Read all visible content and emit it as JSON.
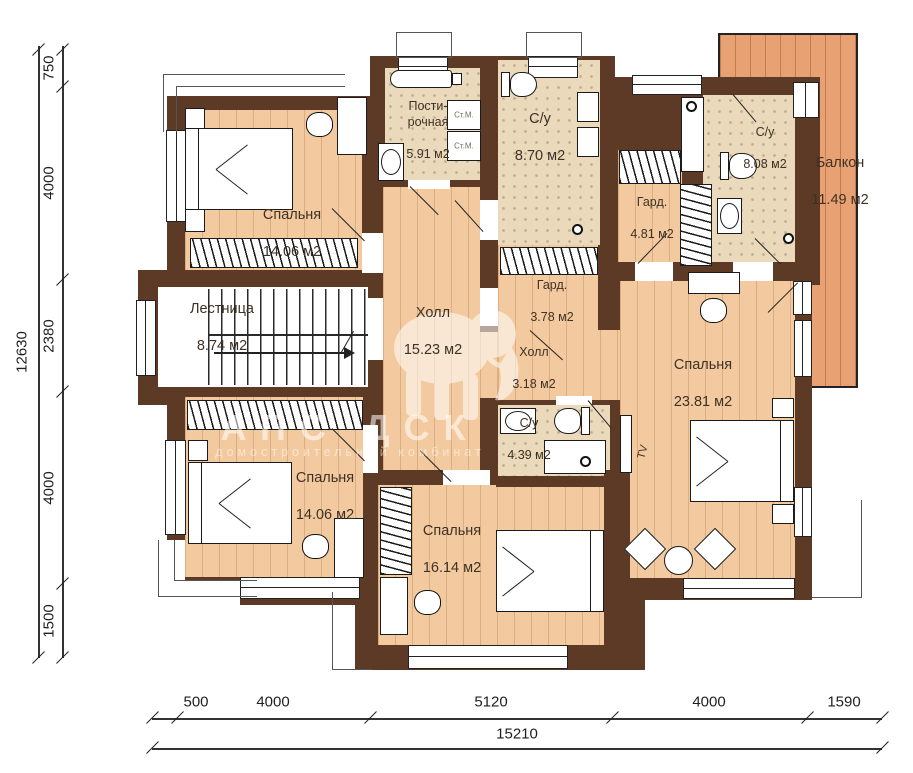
{
  "rooms": [
    {
      "name": "Спальня",
      "area": "14.06 м2"
    },
    {
      "name": "Пости-\nрочная",
      "area": "5.91 м2"
    },
    {
      "name": "С/у",
      "area": "8.70 м2"
    },
    {
      "name": "Гард.",
      "area": "4.81 м2"
    },
    {
      "name": "С/у",
      "area": "8.08 м2"
    },
    {
      "name": "Балкон",
      "area": "11.49 м2"
    },
    {
      "name": "Лестница",
      "area": "8.74 м2"
    },
    {
      "name": "Холл",
      "area": "15.23 м2"
    },
    {
      "name": "Гард.",
      "area": "3.78 м2"
    },
    {
      "name": "Холл",
      "area": "3.18 м2"
    },
    {
      "name": "Спальня",
      "area": "23.81 м2"
    },
    {
      "name": "Спальня",
      "area": "14.06 м2"
    },
    {
      "name": "С/у",
      "area": "4.39 м2"
    },
    {
      "name": "Спальня",
      "area": "16.14 м2"
    }
  ],
  "labels": {
    "washer": "Ст.М.",
    "tv": "TV"
  },
  "watermark": {
    "brand": "АПС ДСК",
    "tagline": "домостроительный комбинат"
  },
  "dimensions": {
    "left": {
      "total": "12630",
      "segments": [
        "750",
        "4000",
        "2380",
        "4000",
        "1500"
      ]
    },
    "bottom": {
      "total": "15210",
      "segments": [
        "500",
        "4000",
        "5120",
        "4000",
        "1590"
      ]
    }
  },
  "colors": {
    "wall": "#5d3a26",
    "wood": "#f3ca9f",
    "balcony": "#e8a173",
    "tile": "#ead9ba"
  }
}
